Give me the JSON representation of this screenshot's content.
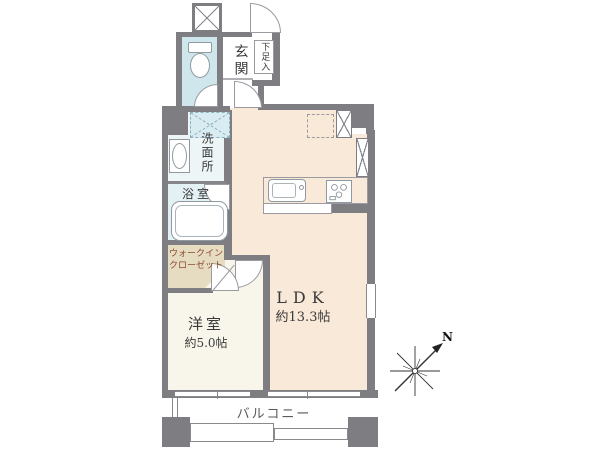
{
  "plan": {
    "title": "apartment-floor-plan",
    "rooms": {
      "genkan": {
        "label": "玄関"
      },
      "shoe_cabinet": {
        "label": "下足入"
      },
      "washroom": {
        "label": "洗面所"
      },
      "bathroom": {
        "label": "浴室"
      },
      "walk_in_closet": {
        "label_line1": "ウォークイン",
        "label_line2": "クローゼット"
      },
      "bedroom": {
        "label": "洋室",
        "size": "約5.0帖"
      },
      "ldk": {
        "label": "LDK",
        "size": "約13.3帖"
      },
      "balcony": {
        "label": "バルコニー"
      }
    },
    "compass": {
      "label": "N"
    },
    "icons": {
      "toilet": "toilet-icon",
      "bathtub": "bathtub-icon",
      "washbasin": "washbasin-icon",
      "kitchen_sink": "kitchen-sink-icon",
      "stove": "stove-icon",
      "washer_space": "washing-machine-space-icon",
      "fridge_space": "refrigerator-space-icon",
      "pipe_shaft": "pipe-shaft-icon",
      "compass": "compass-north-icon"
    },
    "colors": {
      "wall": "#7d7d82",
      "toilet_room": "#cfe7ec",
      "washroom": "#edf5f7",
      "bathroom": "#e3f0f4",
      "washer_space": "#d9ecf1",
      "ldk": "#f9e9d8",
      "bedroom": "#f8f6eb",
      "closet": "#e6dcc2",
      "closet_text": "#8b4a2b"
    }
  }
}
